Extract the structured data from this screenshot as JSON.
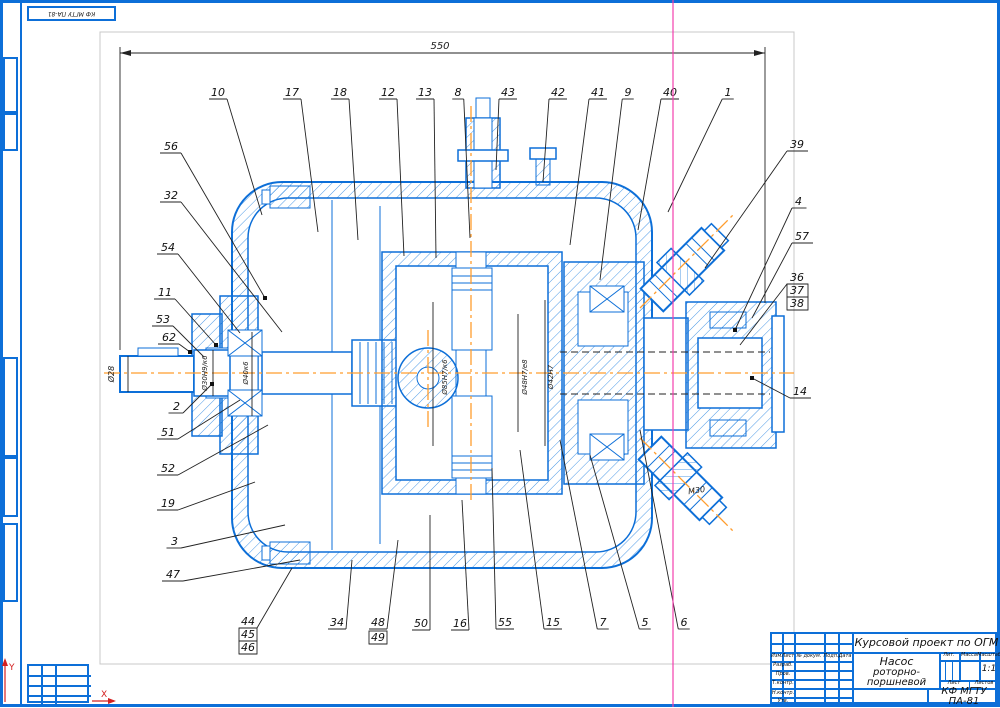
{
  "sheet": {
    "stamp_text": "КФ МГТУ ПА-81",
    "axis_x_label": "X",
    "axis_y_label": "Y"
  },
  "title_block": {
    "project": "Курсовой проект по ОГМ",
    "doc_name_line1": "Насос",
    "doc_name_line2": "роторно-поршневой",
    "org_code": "КФ МГТУ ПА-81",
    "scale_value": "1:1",
    "lit_label": "Лит.",
    "mass_label": "Масса",
    "scale_label": "Масштаб",
    "sheet_label": "Лист",
    "sheets_label": "Листов",
    "col_headers": [
      "Изм.",
      "Лист",
      "№ докум.",
      "Подп.",
      "Дата"
    ],
    "roles": [
      "Разраб.",
      "Пров.",
      "Т.контр.",
      "Н.контр.",
      "Утв."
    ]
  },
  "drawing": {
    "overall_dimension": "550",
    "thread_label": "М30",
    "dimensions": [
      {
        "t": "550",
        "x": 440,
        "y": 49,
        "rot": 0,
        "size": 10
      },
      {
        "t": "Ø28",
        "x": 114,
        "y": 374,
        "rot": -90,
        "size": 8
      },
      {
        "t": "Ø30Н9/к6",
        "x": 207,
        "y": 373,
        "rot": -90,
        "size": 7
      },
      {
        "t": "Ø40к6",
        "x": 248,
        "y": 373,
        "rot": -90,
        "size": 7
      },
      {
        "t": "Ø85Н7/к6",
        "x": 447,
        "y": 377,
        "rot": -90,
        "size": 7
      },
      {
        "t": "Ø48Н7/е8",
        "x": 527,
        "y": 377,
        "rot": -90,
        "size": 7
      },
      {
        "t": "Ø42Н7",
        "x": 553,
        "y": 377,
        "rot": -90,
        "size": 7
      },
      {
        "t": "М30",
        "x": 697,
        "y": 493,
        "rot": -8,
        "size": 8
      }
    ],
    "callouts": [
      {
        "t": "10",
        "x": 218,
        "y": 96,
        "a": "mid",
        "ax": 262,
        "ay": 215
      },
      {
        "t": "17",
        "x": 292,
        "y": 96,
        "a": "mid",
        "ax": 318,
        "ay": 232
      },
      {
        "t": "18",
        "x": 340,
        "y": 96,
        "a": "mid",
        "ax": 358,
        "ay": 240
      },
      {
        "t": "12",
        "x": 388,
        "y": 96,
        "a": "mid",
        "ax": 404,
        "ay": 256
      },
      {
        "t": "13",
        "x": 425,
        "y": 96,
        "a": "mid",
        "ax": 436,
        "ay": 258
      },
      {
        "t": "8",
        "x": 458,
        "y": 96,
        "a": "mid",
        "ax": 470,
        "ay": 238
      },
      {
        "t": "43",
        "x": 508,
        "y": 96,
        "a": "mid",
        "ax": 496,
        "ay": 170
      },
      {
        "t": "42",
        "x": 558,
        "y": 96,
        "a": "mid",
        "ax": 543,
        "ay": 182
      },
      {
        "t": "41",
        "x": 598,
        "y": 96,
        "a": "mid",
        "ax": 570,
        "ay": 245
      },
      {
        "t": "9",
        "x": 628,
        "y": 96,
        "a": "mid",
        "ax": 600,
        "ay": 280
      },
      {
        "t": "40",
        "x": 670,
        "y": 96,
        "a": "mid",
        "ax": 638,
        "ay": 230
      },
      {
        "t": "1",
        "x": 728,
        "y": 96,
        "a": "mid",
        "ax": 668,
        "ay": 212
      },
      {
        "t": "56",
        "x": 178,
        "y": 150,
        "a": "end",
        "ax": 265,
        "ay": 298,
        "dot": true
      },
      {
        "t": "32",
        "x": 178,
        "y": 199,
        "a": "end",
        "ax": 282,
        "ay": 332
      },
      {
        "t": "54",
        "x": 175,
        "y": 251,
        "a": "end",
        "ax": 240,
        "ay": 333
      },
      {
        "t": "11",
        "x": 172,
        "y": 296,
        "a": "end",
        "ax": 216,
        "ay": 345,
        "dot": true
      },
      {
        "t": "53",
        "x": 170,
        "y": 323,
        "a": "end",
        "ax": 204,
        "ay": 357
      },
      {
        "t": "62",
        "x": 176,
        "y": 341,
        "a": "end",
        "ax": 190,
        "ay": 352,
        "dot": true
      },
      {
        "t": "2",
        "x": 180,
        "y": 410,
        "a": "end",
        "ax": 212,
        "ay": 384,
        "dot": true
      },
      {
        "t": "51",
        "x": 175,
        "y": 436,
        "a": "end",
        "ax": 240,
        "ay": 400
      },
      {
        "t": "52",
        "x": 175,
        "y": 472,
        "a": "end",
        "ax": 268,
        "ay": 425
      },
      {
        "t": "19",
        "x": 175,
        "y": 507,
        "a": "end",
        "ax": 255,
        "ay": 482
      },
      {
        "t": "3",
        "x": 178,
        "y": 545,
        "a": "end",
        "ax": 285,
        "ay": 525
      },
      {
        "t": "47",
        "x": 180,
        "y": 578,
        "a": "end",
        "ax": 300,
        "ay": 560
      },
      {
        "t": "39",
        "x": 790,
        "y": 148,
        "a": "start",
        "ax": 705,
        "ay": 268
      },
      {
        "t": "4",
        "x": 795,
        "y": 205,
        "a": "start",
        "ax": 735,
        "ay": 330,
        "dot": true
      },
      {
        "t": "57",
        "x": 795,
        "y": 240,
        "a": "start",
        "ax": 752,
        "ay": 318
      },
      {
        "t": "36",
        "x": 790,
        "y": 281,
        "a": "start",
        "ax": 740,
        "ay": 345
      },
      {
        "t": "37",
        "x": 790,
        "y": 294,
        "a": "start",
        "boxed": true
      },
      {
        "t": "38",
        "x": 790,
        "y": 307,
        "a": "start",
        "boxed": true
      },
      {
        "t": "14",
        "x": 793,
        "y": 395,
        "a": "start",
        "ax": 752,
        "ay": 378,
        "dot": true
      },
      {
        "t": "44",
        "x": 248,
        "y": 625,
        "a": "mid",
        "ax": 292,
        "ay": 568
      },
      {
        "t": "45",
        "x": 248,
        "y": 638,
        "a": "mid",
        "boxed": true
      },
      {
        "t": "46",
        "x": 248,
        "y": 651,
        "a": "mid",
        "boxed": true
      },
      {
        "t": "34",
        "x": 337,
        "y": 626,
        "a": "mid",
        "ax": 352,
        "ay": 560
      },
      {
        "t": "48",
        "x": 378,
        "y": 626,
        "a": "mid",
        "ax": 398,
        "ay": 540
      },
      {
        "t": "49",
        "x": 378,
        "y": 641,
        "a": "mid",
        "boxed": true
      },
      {
        "t": "50",
        "x": 421,
        "y": 627,
        "a": "mid",
        "ax": 430,
        "ay": 515
      },
      {
        "t": "16",
        "x": 460,
        "y": 627,
        "a": "mid",
        "ax": 462,
        "ay": 500
      },
      {
        "t": "55",
        "x": 505,
        "y": 626,
        "a": "mid",
        "ax": 492,
        "ay": 468
      },
      {
        "t": "15",
        "x": 553,
        "y": 626,
        "a": "mid",
        "ax": 520,
        "ay": 450
      },
      {
        "t": "7",
        "x": 603,
        "y": 626,
        "a": "mid",
        "ax": 560,
        "ay": 440
      },
      {
        "t": "5",
        "x": 645,
        "y": 626,
        "a": "mid",
        "ax": 590,
        "ay": 455
      },
      {
        "t": "6",
        "x": 684,
        "y": 626,
        "a": "mid",
        "ax": 640,
        "ay": 430
      }
    ]
  }
}
